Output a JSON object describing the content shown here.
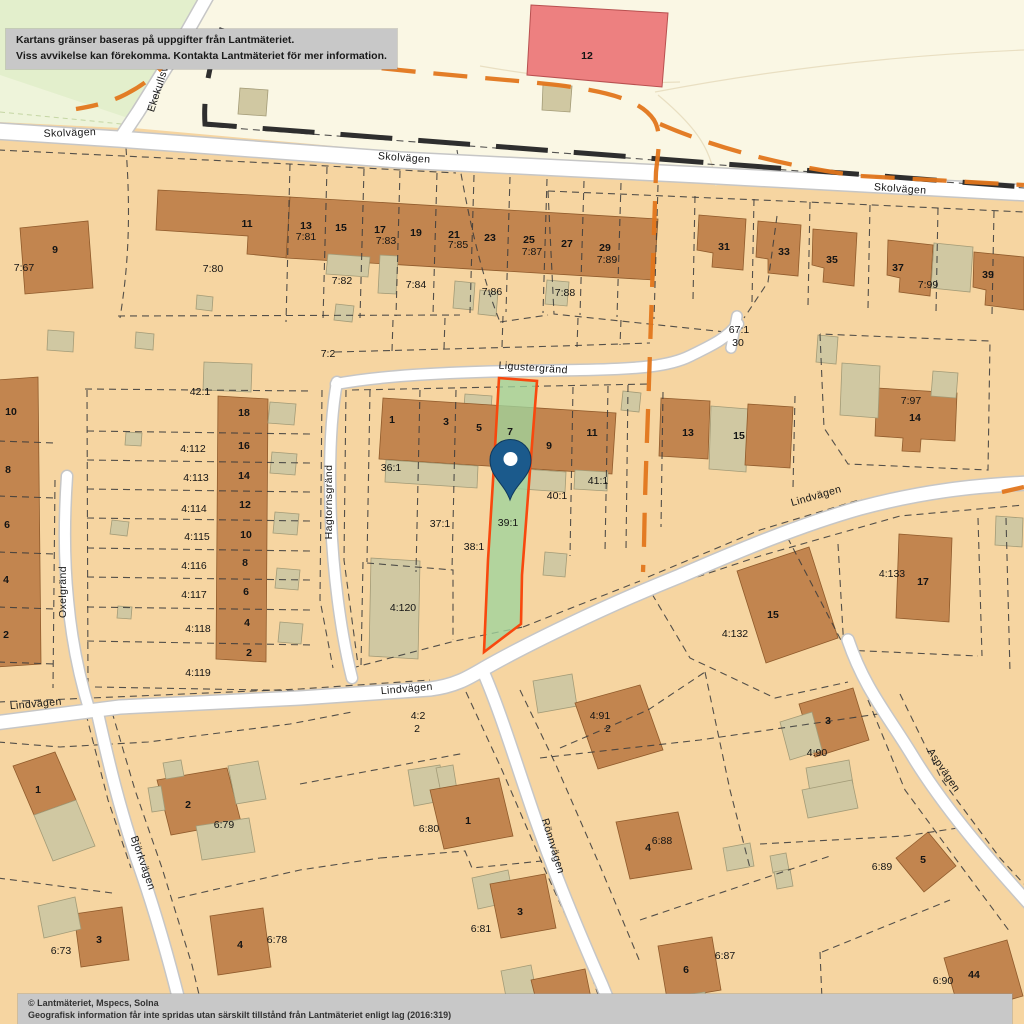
{
  "map": {
    "kind": "cadastral-property-map",
    "highlighted_parcel": "39:1",
    "street_labels": [
      {
        "text": "Skolvägen",
        "x": 70,
        "y": 136,
        "rot": -2
      },
      {
        "text": "Skolvägen",
        "x": 404,
        "y": 161,
        "rot": 4
      },
      {
        "text": "Skolvägen",
        "x": 900,
        "y": 192,
        "rot": 4
      },
      {
        "text": "Ekekullsvägen",
        "x": 165,
        "y": 78,
        "rot": -72
      },
      {
        "text": "Ligustergränd",
        "x": 533,
        "y": 371,
        "rot": 4
      },
      {
        "text": "Hagtornsgränd",
        "x": 332,
        "y": 502,
        "rot": -90
      },
      {
        "text": "Oxelgränd",
        "x": 66,
        "y": 592,
        "rot": -90
      },
      {
        "text": "Lindvägen",
        "x": 36,
        "y": 707,
        "rot": -5
      },
      {
        "text": "Lindvägen",
        "x": 407,
        "y": 692,
        "rot": -5
      },
      {
        "text": "Lindvägen",
        "x": 817,
        "y": 499,
        "rot": -16
      },
      {
        "text": "Björkvägen",
        "x": 140,
        "y": 864,
        "rot": 71
      },
      {
        "text": "Rönnvägen",
        "x": 550,
        "y": 847,
        "rot": 73
      },
      {
        "text": "Aspvägen",
        "x": 941,
        "y": 772,
        "rot": 56
      }
    ],
    "parcel_labels": [
      {
        "text": "7:67",
        "x": 24,
        "y": 271
      },
      {
        "text": "7:80",
        "x": 213,
        "y": 272
      },
      {
        "text": "7:81",
        "x": 306,
        "y": 240
      },
      {
        "text": "7:83",
        "x": 386,
        "y": 244
      },
      {
        "text": "7:85",
        "x": 458,
        "y": 248
      },
      {
        "text": "7:87",
        "x": 532,
        "y": 255
      },
      {
        "text": "7:89",
        "x": 607,
        "y": 263
      },
      {
        "text": "7:82",
        "x": 342,
        "y": 284
      },
      {
        "text": "7:84",
        "x": 416,
        "y": 288
      },
      {
        "text": "7:86",
        "x": 492,
        "y": 295
      },
      {
        "text": "7:88",
        "x": 565,
        "y": 296
      },
      {
        "text": "7:99",
        "x": 928,
        "y": 288
      },
      {
        "text": "67:1",
        "x": 739,
        "y": 333
      },
      {
        "text": "30",
        "x": 738,
        "y": 346
      },
      {
        "text": "7:2",
        "x": 328,
        "y": 357
      },
      {
        "text": "42:1",
        "x": 200,
        "y": 395
      },
      {
        "text": "4:112",
        "x": 193,
        "y": 452
      },
      {
        "text": "4:113",
        "x": 196,
        "y": 481
      },
      {
        "text": "4:114",
        "x": 194,
        "y": 512
      },
      {
        "text": "4:115",
        "x": 197,
        "y": 540
      },
      {
        "text": "4:116",
        "x": 194,
        "y": 569
      },
      {
        "text": "4:117",
        "x": 194,
        "y": 598
      },
      {
        "text": "4:118",
        "x": 198,
        "y": 632
      },
      {
        "text": "4:119",
        "x": 198,
        "y": 676
      },
      {
        "text": "36:1",
        "x": 391,
        "y": 471
      },
      {
        "text": "37:1",
        "x": 440,
        "y": 527
      },
      {
        "text": "38:1",
        "x": 474,
        "y": 550
      },
      {
        "text": "39:1",
        "x": 508,
        "y": 526,
        "fill": "#649a66"
      },
      {
        "text": "40:1",
        "x": 557,
        "y": 499
      },
      {
        "text": "41:1",
        "x": 598,
        "y": 484
      },
      {
        "text": "4:120",
        "x": 403,
        "y": 611
      },
      {
        "text": "7:97",
        "x": 911,
        "y": 404
      },
      {
        "text": "4:133",
        "x": 892,
        "y": 577
      },
      {
        "text": "4:132",
        "x": 735,
        "y": 637
      },
      {
        "text": "4:2",
        "x": 418,
        "y": 719
      },
      {
        "text": "2",
        "x": 417,
        "y": 732
      },
      {
        "text": "4:91",
        "x": 600,
        "y": 719
      },
      {
        "text": "2",
        "x": 608,
        "y": 732
      },
      {
        "text": "4:90",
        "x": 817,
        "y": 756
      },
      {
        "text": "6:79",
        "x": 224,
        "y": 828
      },
      {
        "text": "6:80",
        "x": 429,
        "y": 832
      },
      {
        "text": "6:88",
        "x": 662,
        "y": 844
      },
      {
        "text": "6:73",
        "x": 61,
        "y": 954
      },
      {
        "text": "6:78",
        "x": 277,
        "y": 943
      },
      {
        "text": "6:81",
        "x": 481,
        "y": 932
      },
      {
        "text": "6:89",
        "x": 882,
        "y": 870
      },
      {
        "text": "6:87",
        "x": 725,
        "y": 959
      },
      {
        "text": "6:90",
        "x": 943,
        "y": 984
      }
    ],
    "house_numbers": [
      {
        "text": "9",
        "x": 55,
        "y": 253
      },
      {
        "text": "11",
        "x": 247,
        "y": 227
      },
      {
        "text": "13",
        "x": 306,
        "y": 229
      },
      {
        "text": "15",
        "x": 341,
        "y": 231
      },
      {
        "text": "17",
        "x": 380,
        "y": 233
      },
      {
        "text": "19",
        "x": 416,
        "y": 236
      },
      {
        "text": "21",
        "x": 454,
        "y": 238
      },
      {
        "text": "23",
        "x": 490,
        "y": 241
      },
      {
        "text": "25",
        "x": 529,
        "y": 243
      },
      {
        "text": "27",
        "x": 567,
        "y": 247
      },
      {
        "text": "29",
        "x": 605,
        "y": 251
      },
      {
        "text": "31",
        "x": 724,
        "y": 250
      },
      {
        "text": "33",
        "x": 784,
        "y": 255
      },
      {
        "text": "35",
        "x": 832,
        "y": 263
      },
      {
        "text": "37",
        "x": 898,
        "y": 271
      },
      {
        "text": "39",
        "x": 988,
        "y": 278
      },
      {
        "text": "12",
        "x": 587,
        "y": 59
      },
      {
        "text": "18",
        "x": 244,
        "y": 416
      },
      {
        "text": "16",
        "x": 244,
        "y": 449
      },
      {
        "text": "14",
        "x": 244,
        "y": 479
      },
      {
        "text": "12",
        "x": 245,
        "y": 508
      },
      {
        "text": "10",
        "x": 246,
        "y": 538
      },
      {
        "text": "8",
        "x": 245,
        "y": 566
      },
      {
        "text": "6",
        "x": 246,
        "y": 595
      },
      {
        "text": "4",
        "x": 247,
        "y": 626
      },
      {
        "text": "2",
        "x": 249,
        "y": 656
      },
      {
        "text": "10",
        "x": 11,
        "y": 415
      },
      {
        "text": "8",
        "x": 8,
        "y": 473
      },
      {
        "text": "6",
        "x": 7,
        "y": 528
      },
      {
        "text": "4",
        "x": 6,
        "y": 583
      },
      {
        "text": "2",
        "x": 6,
        "y": 638
      },
      {
        "text": "1",
        "x": 392,
        "y": 423
      },
      {
        "text": "3",
        "x": 446,
        "y": 425
      },
      {
        "text": "5",
        "x": 479,
        "y": 431
      },
      {
        "text": "7",
        "x": 510,
        "y": 435,
        "fill": "#5f8763"
      },
      {
        "text": "9",
        "x": 549,
        "y": 449
      },
      {
        "text": "11",
        "x": 592,
        "y": 436
      },
      {
        "text": "13",
        "x": 688,
        "y": 436
      },
      {
        "text": "15",
        "x": 739,
        "y": 439
      },
      {
        "text": "14",
        "x": 915,
        "y": 421
      },
      {
        "text": "17",
        "x": 923,
        "y": 585
      },
      {
        "text": "15",
        "x": 773,
        "y": 618
      },
      {
        "text": "3",
        "x": 828,
        "y": 724
      },
      {
        "text": "1",
        "x": 38,
        "y": 793
      },
      {
        "text": "2",
        "x": 188,
        "y": 808
      },
      {
        "text": "1",
        "x": 468,
        "y": 824
      },
      {
        "text": "3",
        "x": 520,
        "y": 915
      },
      {
        "text": "5",
        "x": 560,
        "y": 1010
      },
      {
        "text": "4",
        "x": 648,
        "y": 851
      },
      {
        "text": "3",
        "x": 99,
        "y": 943
      },
      {
        "text": "4",
        "x": 240,
        "y": 948
      },
      {
        "text": "5",
        "x": 923,
        "y": 863
      },
      {
        "text": "6",
        "x": 686,
        "y": 973
      },
      {
        "text": "44",
        "x": 974,
        "y": 978
      }
    ]
  },
  "disclaimer": {
    "line1": "Kartans gränser baseras på uppgifter från Lantmäteriet.",
    "line2": "Viss avvikelse kan förekomma. Kontakta Lantmäteriet för mer information."
  },
  "copyright": {
    "line1": "© Lantmäteriet, Mspecs, Solna",
    "line2": "Geografisk information får inte spridas utan särskilt tillstånd från Lantmäteriet enligt lag (2016:319)"
  },
  "colors": {
    "land": "#f6d5a1",
    "field": "#faf7e4",
    "green": "#e3efcc",
    "green_light": "#eef4da",
    "building": "#c2854f",
    "outbuilding": "#d0c8a2",
    "special_building": "#ed8080",
    "road": "#ffffff",
    "road_casing": "#c6c6c6",
    "parcel_line": "#3c3c3c",
    "boundary_municipal": "#e2761c",
    "highlight_fill": "#9fd49c",
    "highlight_border": "#f8480e",
    "pin_fill": "#1b5a8c",
    "pin_inner": "#ffffff"
  }
}
